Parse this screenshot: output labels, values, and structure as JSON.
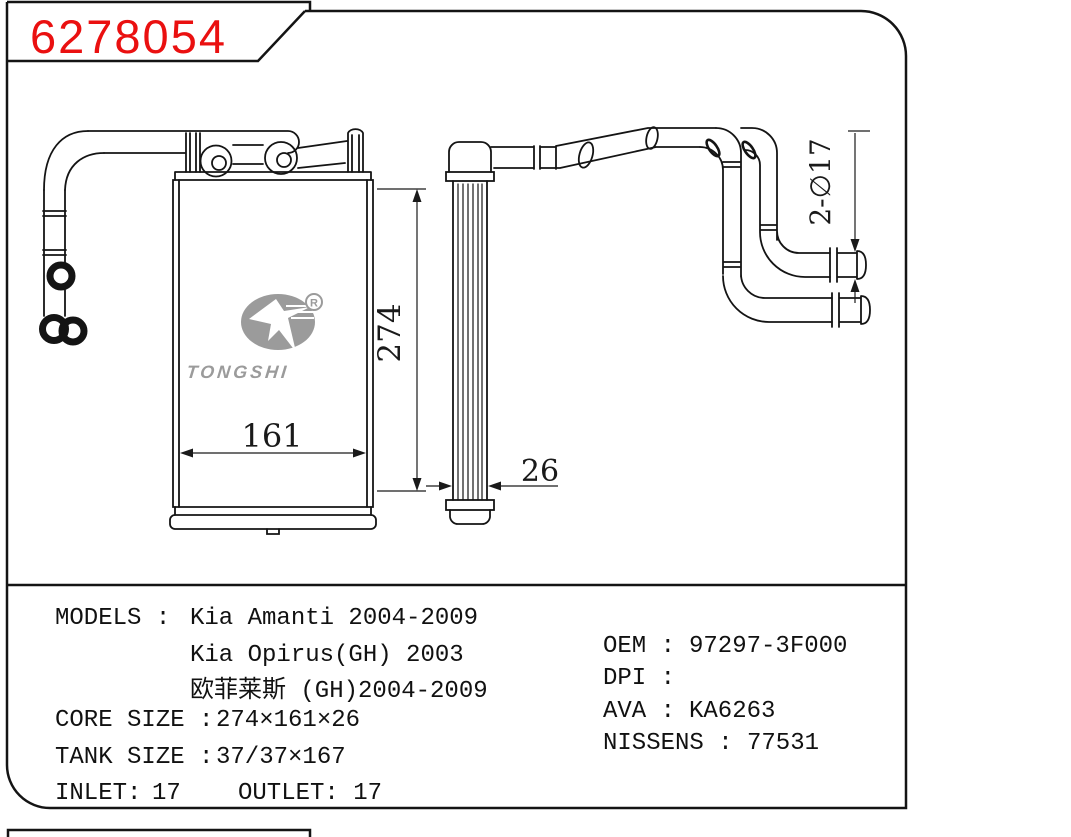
{
  "title": {
    "part_number": "6278054"
  },
  "logo": {
    "text": "TONGSHI",
    "registered_mark": "R"
  },
  "dimensions": {
    "core_height": "274",
    "core_width": "161",
    "core_depth": "26",
    "pipe_diameter": "2-∅17"
  },
  "specs": {
    "models_label": "MODELS :",
    "models": [
      "Kia Amanti 2004-2009",
      "Kia Opirus(GH) 2003",
      "欧菲莱斯 (GH)2004-2009"
    ],
    "core_size_label": "CORE SIZE :",
    "core_size_value": "274×161×26",
    "tank_size_label": "TANK SIZE :",
    "tank_size_value": "37/37×167",
    "inlet_label": "INLET:",
    "inlet_value": "17",
    "outlet_label": "OUTLET:",
    "outlet_value": "17"
  },
  "cross_references": {
    "oem_label": "OEM :",
    "oem_value": "97297-3F000",
    "dpi_label": "DPI :",
    "dpi_value": "",
    "ava_label": "AVA :",
    "ava_value": "KA6263",
    "nissens_label": "NISSENS :",
    "nissens_value": "77531"
  },
  "colors": {
    "part_number_red": "#ea1010",
    "line_black": "#141414",
    "logo_gray": "#9b9b9b"
  }
}
